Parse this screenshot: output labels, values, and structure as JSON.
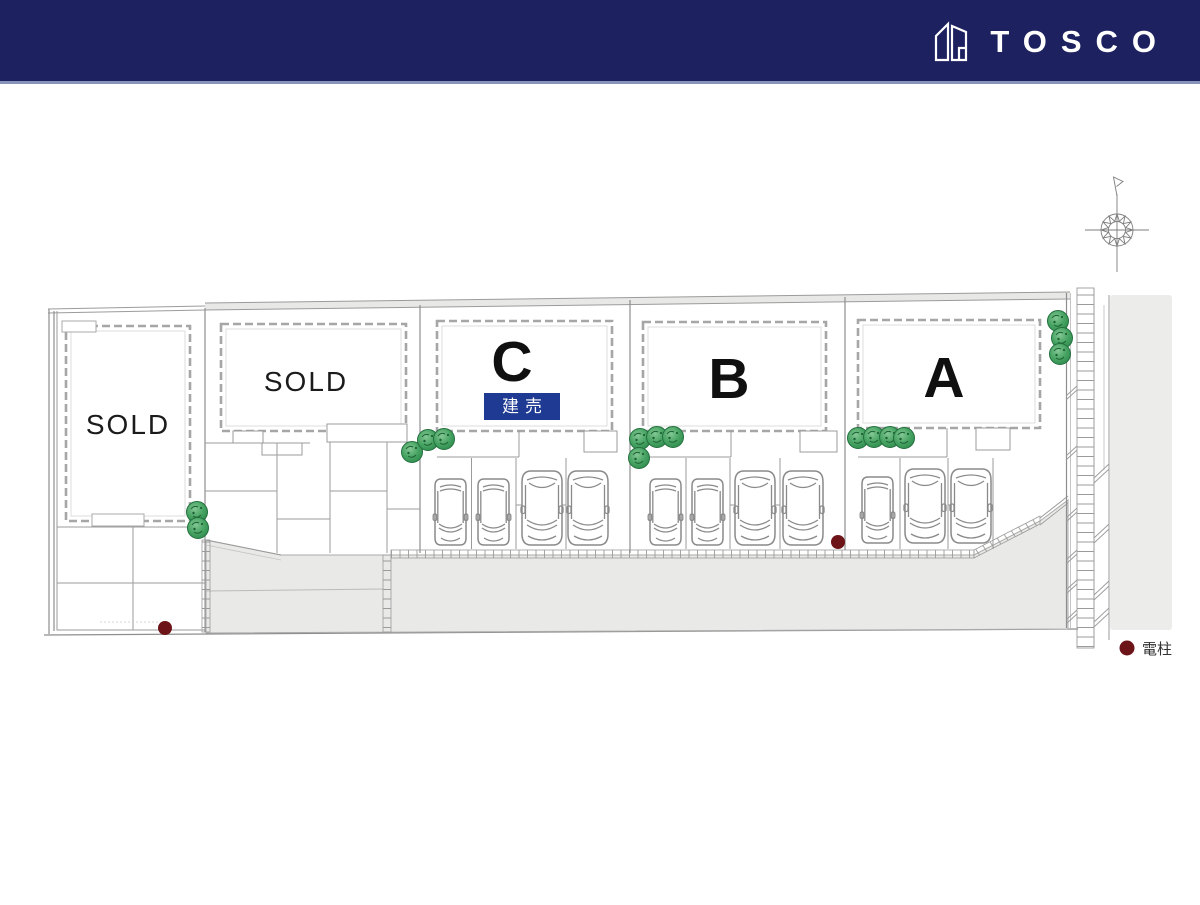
{
  "header": {
    "brand": "TOSCO"
  },
  "plan": {
    "lots": [
      {
        "id": "sold-1",
        "label": "SOLD",
        "status": "sold"
      },
      {
        "id": "sold-2",
        "label": "SOLD",
        "status": "sold"
      },
      {
        "id": "c",
        "label": "C",
        "status": "for-sale",
        "badge": "建売"
      },
      {
        "id": "b",
        "label": "B",
        "status": "for-sale"
      },
      {
        "id": "a",
        "label": "A",
        "status": "for-sale"
      }
    ],
    "legend": {
      "symbol": "utility-pole",
      "label": "電柱"
    },
    "icons": [
      "north-compass",
      "tree",
      "car",
      "utility-pole-dot",
      "house-logo"
    ],
    "colors": {
      "header_bg": "#1d2160",
      "badge_bg": "#1e3a92",
      "road_fill": "#e9e9e8",
      "side_fill": "#ececeb",
      "line": "#8b8b8b",
      "tree": "#3fa35d",
      "pole": "#6d1418"
    }
  }
}
